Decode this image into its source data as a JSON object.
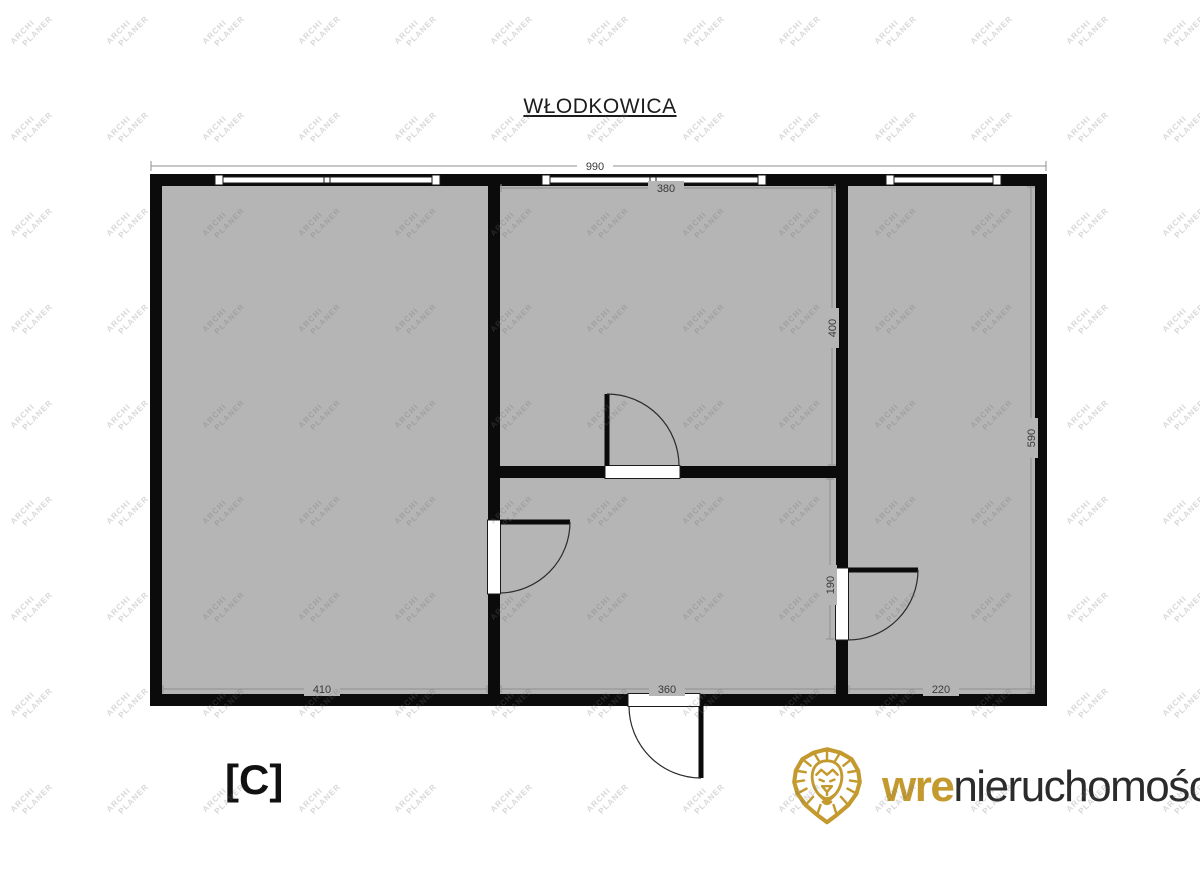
{
  "title": "WŁODKOWICA",
  "unit_label": "[C]",
  "watermark": {
    "line1": "ARCHI",
    "line2": "PLANER"
  },
  "logo": {
    "icon": "lion-icon",
    "brand_bold": "wre",
    "brand_rest": "nieruchomości"
  },
  "colors": {
    "room_fill": "#b5b5b5",
    "wall": "#0b0b0b",
    "dim_line": "#8f8f8f",
    "dim_text": "#3a3a3a",
    "logo_gold": "#c49a2e",
    "logo_text": "#2b2b2b",
    "watermark": "rgba(110,110,110,0.28)"
  },
  "dimensions": {
    "overall_width": "990",
    "top_room_width": "380",
    "top_room_height": "400",
    "right_room_height": "590",
    "right_door_span": "190",
    "left_room_width": "410",
    "bottom_room_width": "360",
    "right_room_width": "220"
  }
}
